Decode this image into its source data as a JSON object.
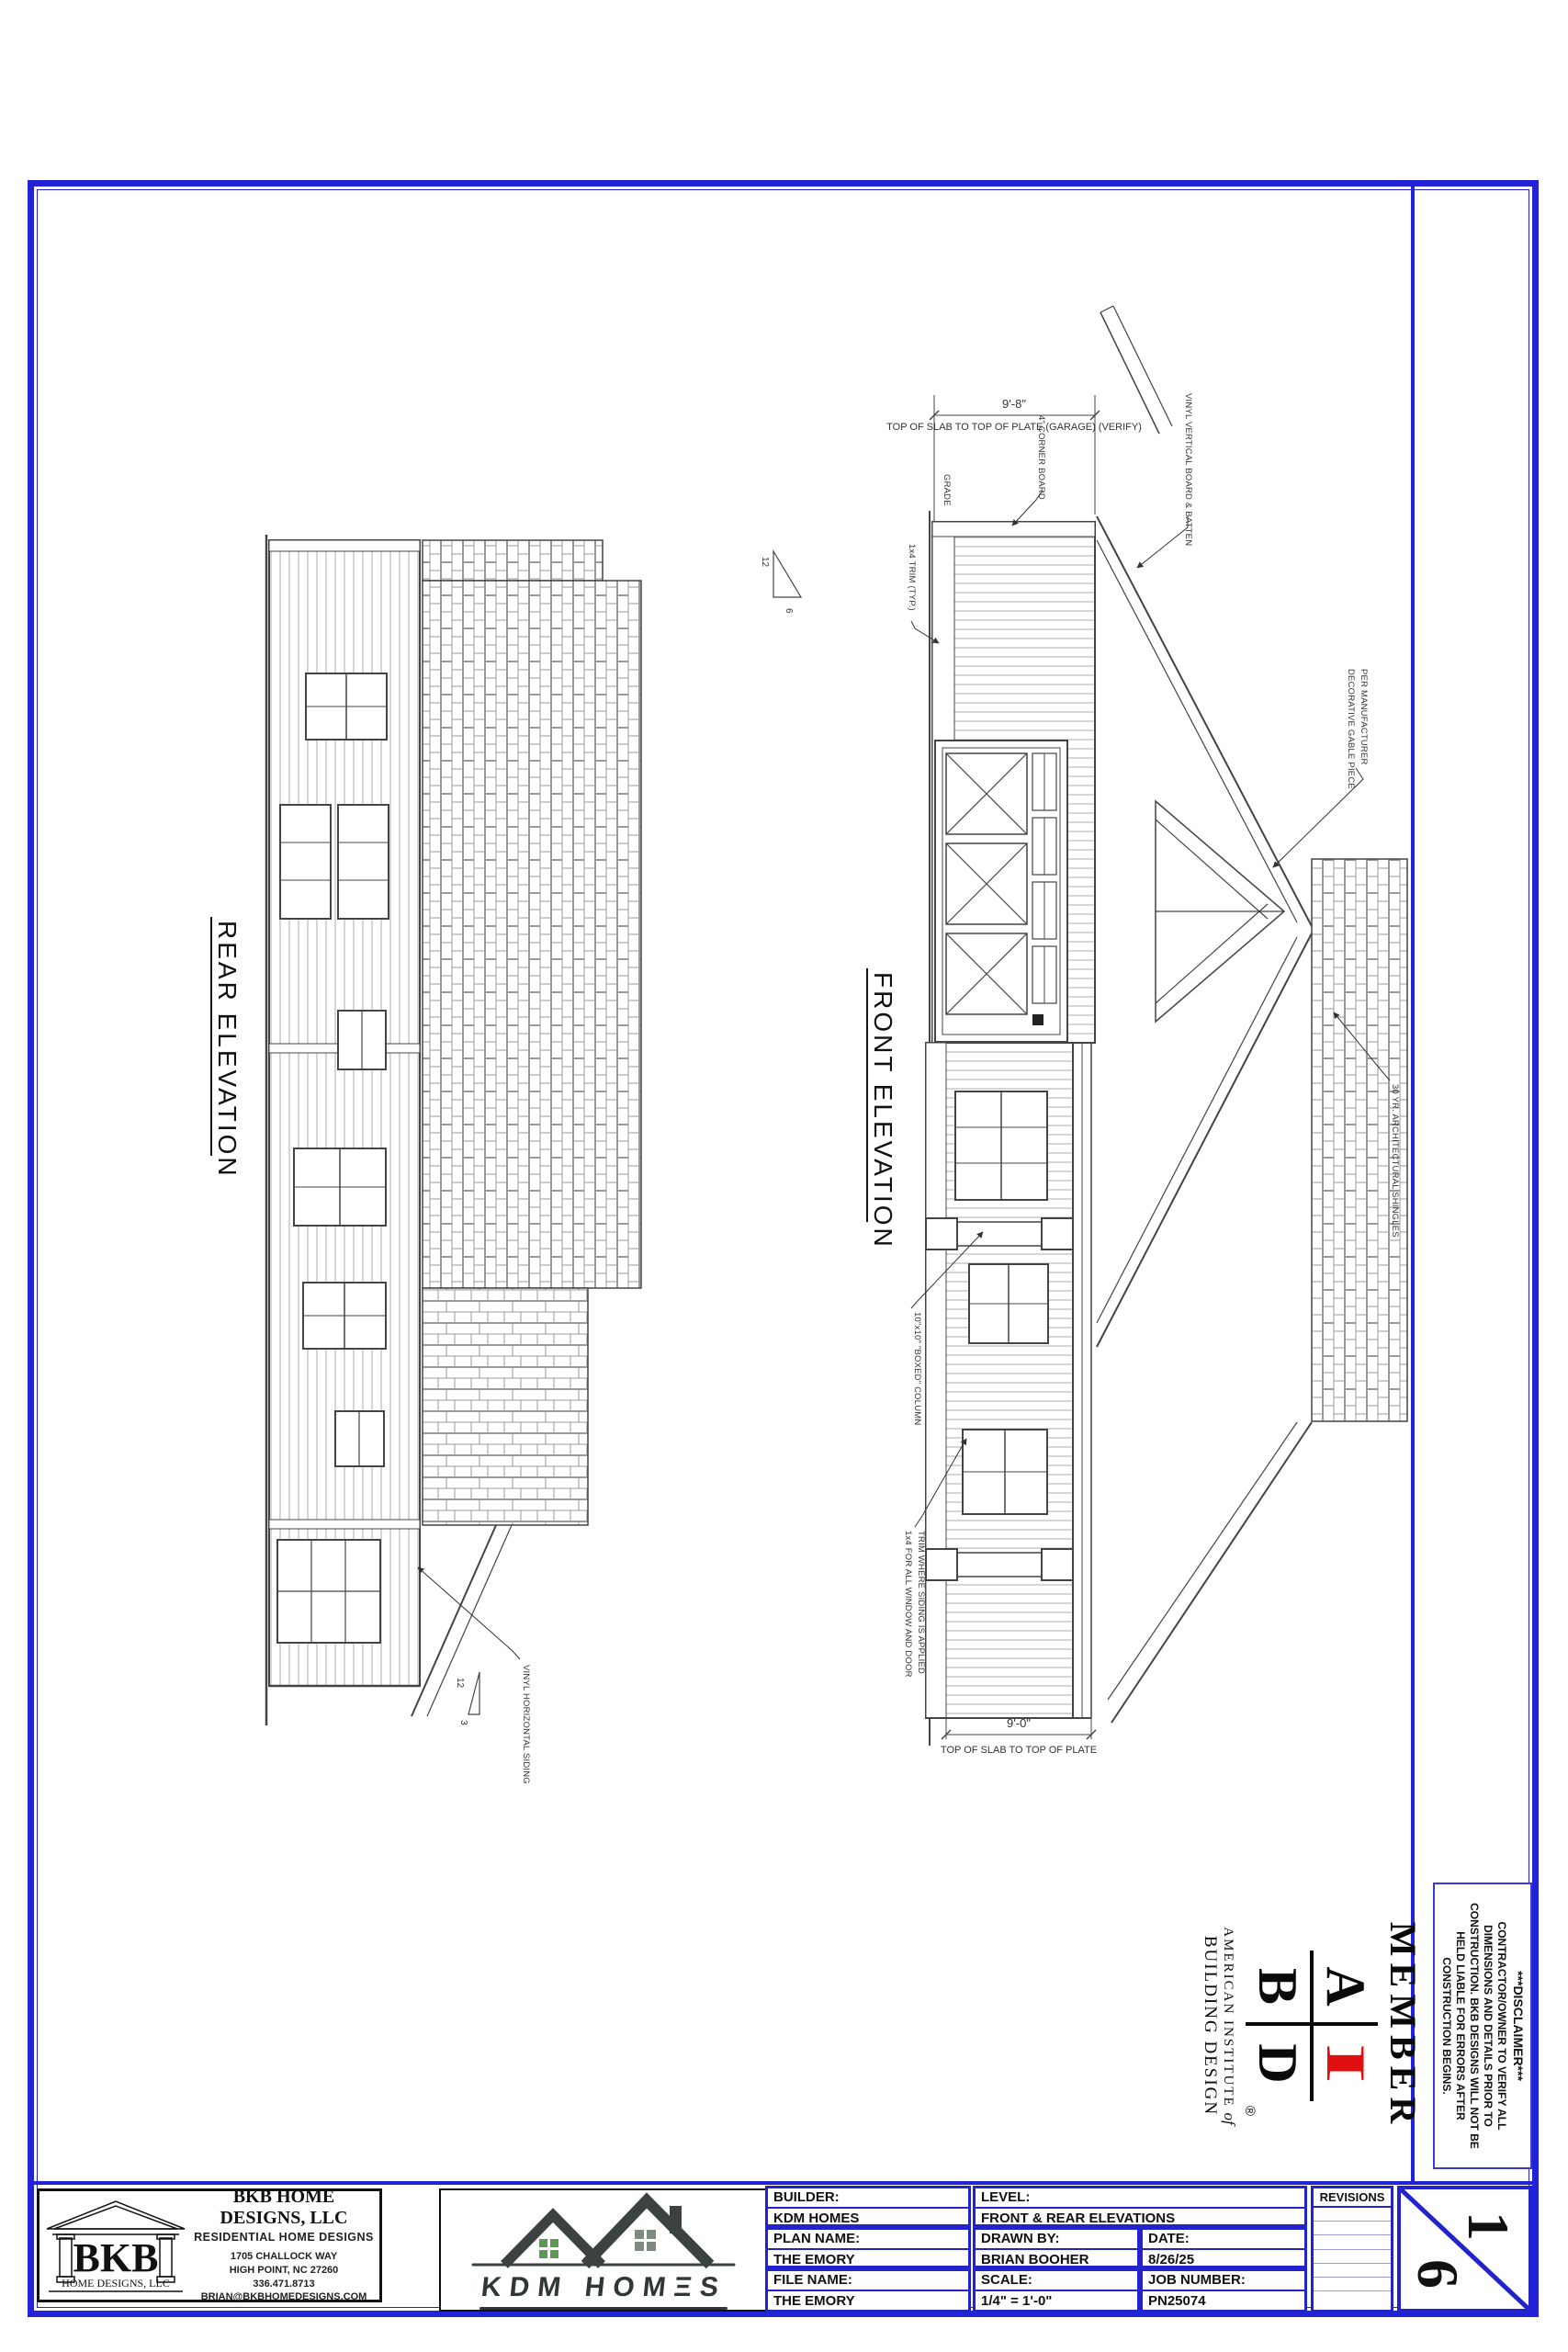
{
  "page": {
    "sheet_top": "1",
    "sheet_bottom": "6"
  },
  "elevations": {
    "rear_label": "REAR ELEVATION",
    "front_label": "FRONT ELEVATION"
  },
  "dimensions": {
    "garage_value": "9'-8\"",
    "garage_label": "TOP OF SLAB TO TOP OF PLATE (GARAGE) (VERIFY)",
    "main_value": "9'-0\"",
    "main_label": "TOP OF SLAB TO TOP OF PLATE"
  },
  "annotations": {
    "grade": "GRADE",
    "trim": "1x4 TRIM (TYP.)",
    "corner_board": "4\" CORNER BOARD",
    "board_batten": "VINYL VERTICAL BOARD & BATTEN",
    "gable_piece_1": "DECORATIVE GABLE PIECE",
    "gable_piece_2": "PER MANUFACTURER",
    "shingles": "30 YR. ARCHITECTURAL SHINGLES",
    "column": "10\"x10\" \"BOXED\" COLUMN",
    "window_trim_1": "1x4 FOR ALL WINDOW AND DOOR",
    "window_trim_2": "TRIM WHERE SIDING IS APPLIED",
    "horizontal_siding": "VINYL HORIZONTAL SIDING",
    "pitch_front_run": "12",
    "pitch_front_rise": "6",
    "pitch_rear_run": "12",
    "pitch_rear_rise": "3"
  },
  "member_block": {
    "member": "MEMBER",
    "letter_a": "A",
    "letter_i": "I",
    "letter_b": "B",
    "letter_d": "D",
    "registered": "®",
    "institute_line1": "AMERICAN  INSTITUTE",
    "institute_of": "of",
    "institute_line2": "BUILDING DESIGN"
  },
  "disclaimer": {
    "title": "***DISCLAIMER***",
    "body": "CONTRACTOR/OWNER TO VERIFY ALL DIMENSIONS AND DETAILS PRIOR TO CONSTRUCTION. BKB DESIGNS WILL NOT BE HELD LIABLE FOR ERRORS AFTER CONSTRUCTION BEGINS."
  },
  "bkb": {
    "logo_text": "BKB",
    "logo_sub": "HOME DESIGNS, LLC",
    "name": "BKB HOME DESIGNS, LLC",
    "tagline": "RESIDENTIAL HOME DESIGNS",
    "address1": "1705 CHALLOCK WAY",
    "address2": "HIGH POINT, NC 27260",
    "phone": "336.471.8713",
    "email": "BRIAN@BKBHOMEDESIGNS.COM"
  },
  "kdm": {
    "logo_text": "KDM HOMΞS"
  },
  "titleblock": {
    "builder_label": "BUILDER:",
    "builder": "KDM HOMES",
    "level_label": "LEVEL:",
    "level": "FRONT & REAR ELEVATIONS",
    "plan_label": "PLAN NAME:",
    "plan": "THE EMORY",
    "drawn_label": "DRAWN BY:",
    "drawn": "BRIAN BOOHER",
    "date_label": "DATE:",
    "date": "8/26/25",
    "file_label": "FILE NAME:",
    "file": "THE EMORY",
    "scale_label": "SCALE:",
    "scale": "1/4\" = 1'-0\"",
    "job_label": "JOB NUMBER:",
    "job": "PN25074",
    "revisions_label": "REVISIONS"
  },
  "colors": {
    "border_blue": "#2222d6",
    "accent_red": "#e01010",
    "kdm_green": "#5a9a55",
    "kdm_dark": "#3c4242"
  }
}
